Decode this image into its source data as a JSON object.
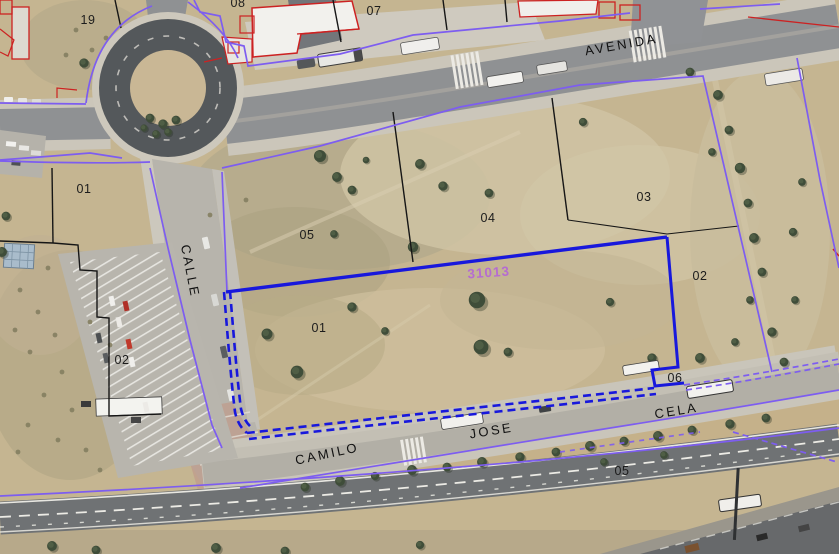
{
  "map": {
    "street_labels": [
      {
        "text": "AVENIDA"
      },
      {
        "text": "CALLE"
      },
      {
        "text": "CAMILO"
      },
      {
        "text": "JOSE"
      },
      {
        "text": "CELA"
      }
    ],
    "parcel_labels": [
      {
        "text": "19"
      },
      {
        "text": "08"
      },
      {
        "text": "07"
      },
      {
        "text": "01"
      },
      {
        "text": "05"
      },
      {
        "text": "04"
      },
      {
        "text": "03"
      },
      {
        "text": "02"
      },
      {
        "text": "01"
      },
      {
        "text": "02"
      },
      {
        "text": "06"
      },
      {
        "text": "05"
      }
    ],
    "reference_label": {
      "text": "31013"
    },
    "colors": {
      "highlight_parcel_blue": "#1818dc",
      "cadastral_violet": "#7d5df0",
      "reference_purple": "#b465d8",
      "building_outline_red": "#cc2222",
      "parcel_line_black": "#1a1a1a"
    }
  }
}
